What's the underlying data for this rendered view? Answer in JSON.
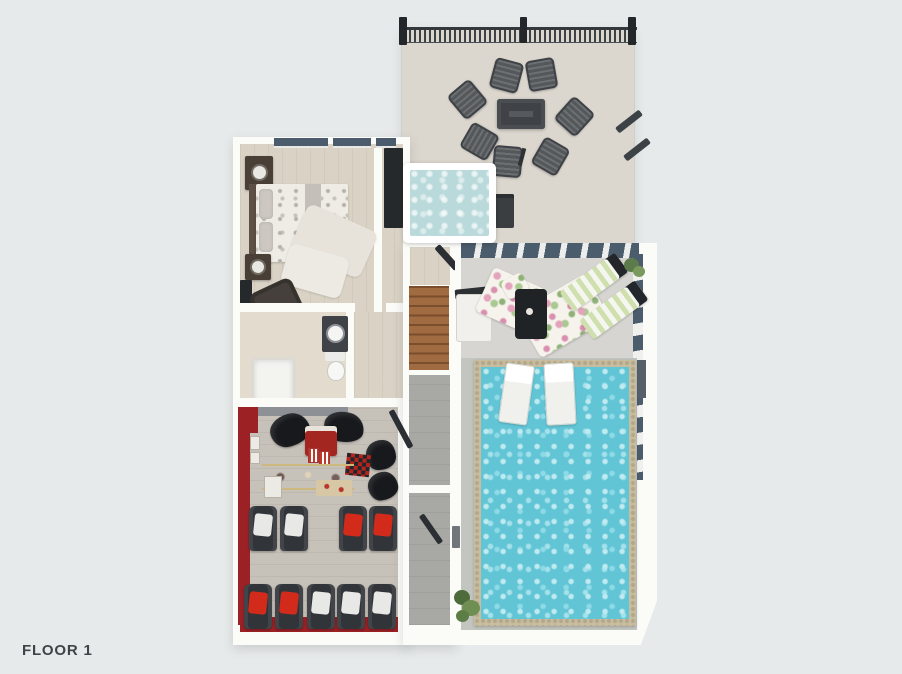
{
  "floor_label": "FLOOR 1",
  "colors": {
    "background": "#e7eaea",
    "wall": "#fbfbf8",
    "wood_floor": "#d9d2c5",
    "theater_floor": "#c6c1b9",
    "theater_red": "#9b2125",
    "seat_dark": "#31353a",
    "seat_cushion_red": "#d32b1b",
    "seat_cushion_white": "#e8e8e6",
    "deck_floor": "#dbd6ce",
    "fence_dark": "#3d4246",
    "hot_tub_water": "#b9d9da",
    "pool_water": "#62c5d6",
    "pool_coping": "#c9bda0",
    "pool_deck": "#c3c5c0",
    "window_glass": "#4b5c6c",
    "stairs_wood": "#a06b40",
    "hall_floor": "#a8a9a5",
    "label_text": "#3f4446"
  }
}
